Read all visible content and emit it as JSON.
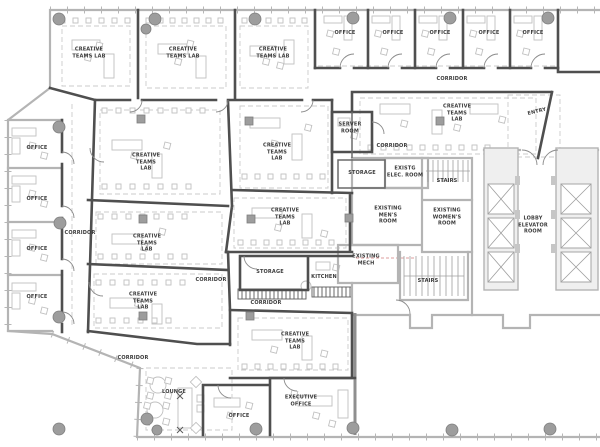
{
  "plan": {
    "rooms": [
      {
        "label": "CREATIVE TEAMS LAB"
      },
      {
        "label": "CREATIVE TEAMS LAB"
      },
      {
        "label": "CREATIVE TEAMS LAB"
      },
      {
        "label": "OFFICE"
      },
      {
        "label": "OFFICE"
      },
      {
        "label": "OFFICE"
      },
      {
        "label": "OFFICE"
      },
      {
        "label": "OFFICE"
      },
      {
        "label": "CORRIDOR"
      },
      {
        "label": "CREATIVE TEAMS LAB"
      },
      {
        "label": "ENTRY"
      },
      {
        "label": "SERVER ROOM"
      },
      {
        "label": "CORRIDOR"
      },
      {
        "label": "STORAGE"
      },
      {
        "label": "EXISTG ELEC. ROOM"
      },
      {
        "label": "STAIRS"
      },
      {
        "label": "EXISTING MEN'S ROOM"
      },
      {
        "label": "EXISTING WOMEN'S ROOM"
      },
      {
        "label": "LOBBY ELEVATOR ROOM"
      },
      {
        "label": "EXISTING MECH"
      },
      {
        "label": "STAIRS"
      },
      {
        "label": "CREATIVE TEAMS LAB"
      },
      {
        "label": "CREATIVE TEAMS LAB"
      },
      {
        "label": "CREATIVE TEAMS LAB"
      },
      {
        "label": "CREATIVE TEAMS LAB"
      },
      {
        "label": "CREATIVE TEAMS LAB"
      },
      {
        "label": "CREATIVE TEAMS LAB"
      },
      {
        "label": "OFFICE"
      },
      {
        "label": "OFFICE"
      },
      {
        "label": "OFFICE"
      },
      {
        "label": "OFFICE"
      },
      {
        "label": "CORRIDOR"
      },
      {
        "label": "CORRIDOR"
      },
      {
        "label": "CORRIDOR"
      },
      {
        "label": "CORRIDOR"
      },
      {
        "label": "STORAGE"
      },
      {
        "label": "KITCHEN"
      },
      {
        "label": "LOUNGE"
      },
      {
        "label": "OFFICE"
      },
      {
        "label": "EXECUTIVE OFFICE"
      }
    ],
    "colors": {
      "background": "#ffffff",
      "wall_new": "#4f4f4f",
      "wall_existing": "#b4b4b4",
      "column": "#9d9d9d",
      "furniture": "#c0c0c0",
      "dashed_guide": "#cbcbcb",
      "accent_dashed": "#dd9d9d",
      "text": "#3b3b3b"
    }
  }
}
